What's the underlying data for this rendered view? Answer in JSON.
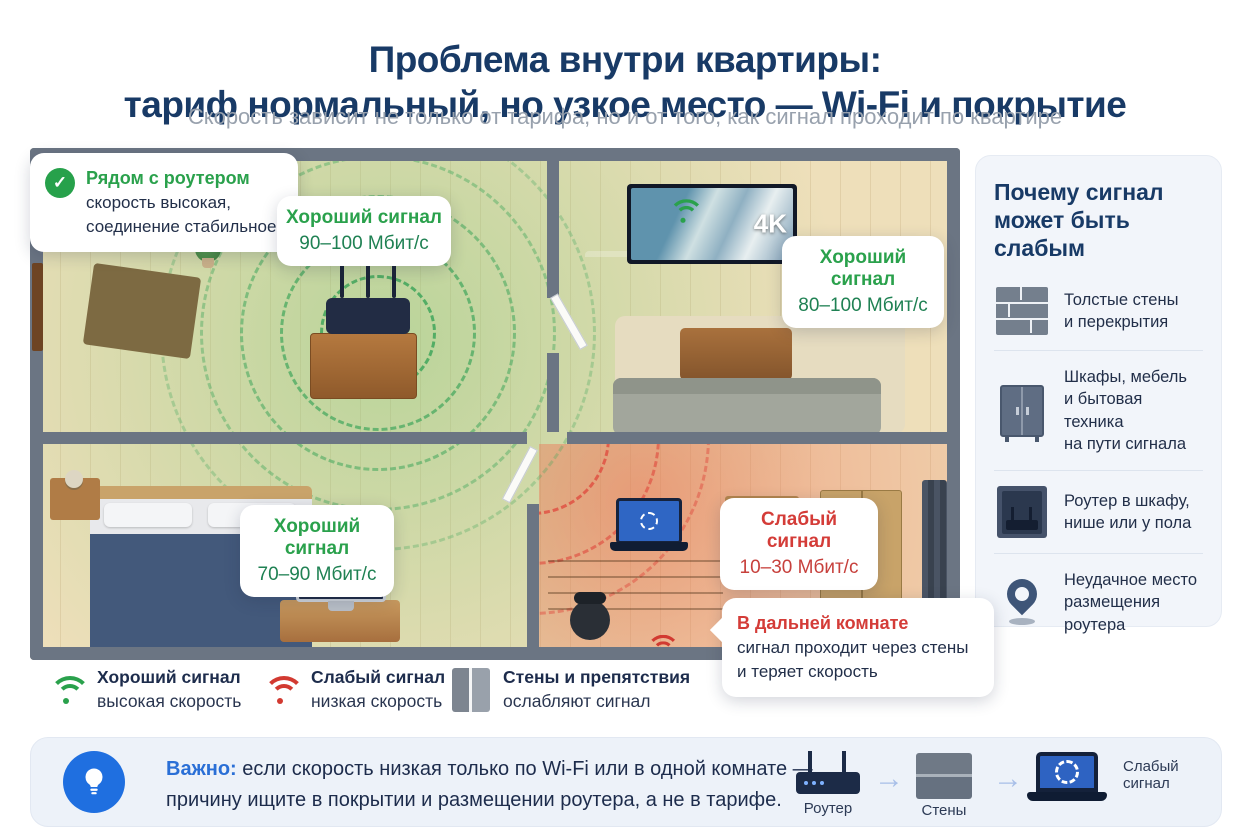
{
  "header": {
    "title": "Проблема внутри квартиры:\nтариф нормальный, но узкое место — Wi-Fi и покрытие",
    "subtitle": "Скорость зависит не только от тарифа, но и от того, как сигнал проходит по квартире"
  },
  "floorplan": {
    "tv_badge": "4K",
    "callouts": {
      "near_router": {
        "title": "Рядом с роутером",
        "body": "скорость высокая,\nсоединение стабильное"
      },
      "center": {
        "title": "Хороший сигнал",
        "value": "90–100 Мбит/с"
      },
      "living": {
        "title": "Хороший сигнал",
        "value": "80–100 Мбит/с"
      },
      "bedroom": {
        "title": "Хороший сигнал",
        "value": "70–90 Мбит/с"
      },
      "far": {
        "title": "Слабый сигнал",
        "value": "10–30 Мбит/с"
      },
      "far_note": {
        "title": "В дальней комнате",
        "body": "сигнал проходит через стены\nи теряет скорость"
      }
    }
  },
  "sidebar": {
    "title": "Почему сигнал\nможет быть слабым",
    "items": [
      {
        "icon": "brick-wall-icon",
        "text": "Толстые стены\nи перекрытия"
      },
      {
        "icon": "wardrobe-icon",
        "text": "Шкафы, мебель\nи бытовая техника\nна пути сигнала"
      },
      {
        "icon": "router-in-niche-icon",
        "text": "Роутер в шкафу,\nнише или у пола"
      },
      {
        "icon": "location-pin-icon",
        "text": "Неудачное место\nразмещения роутера"
      }
    ]
  },
  "legend": {
    "items": [
      {
        "icon": "wifi-good-icon",
        "label": "Хороший сигнал",
        "sub": "высокая скорость"
      },
      {
        "icon": "wifi-weak-icon",
        "label": "Слабый сигнал",
        "sub": "низкая скорость"
      },
      {
        "icon": "wall-icon",
        "label": "Стены и препятствия",
        "sub": "ослабляют сигнал"
      }
    ]
  },
  "footer": {
    "label": "Важно:",
    "text": "если скорость низкая только по Wi-Fi или в одной комнате —\nпричину ищите в покрытии и размещении роутера, а не в тарифе.",
    "flow": [
      {
        "icon": "router-icon",
        "label": "Роутер"
      },
      {
        "icon": "wall-icon",
        "label": "Стены"
      },
      {
        "icon": "laptop-icon",
        "label": "Слабый\nсигнал"
      }
    ]
  },
  "colors": {
    "accent_green": "#2aa14c",
    "accent_red": "#d43c38",
    "navy": "#183a66",
    "blue": "#2a6fd6"
  }
}
